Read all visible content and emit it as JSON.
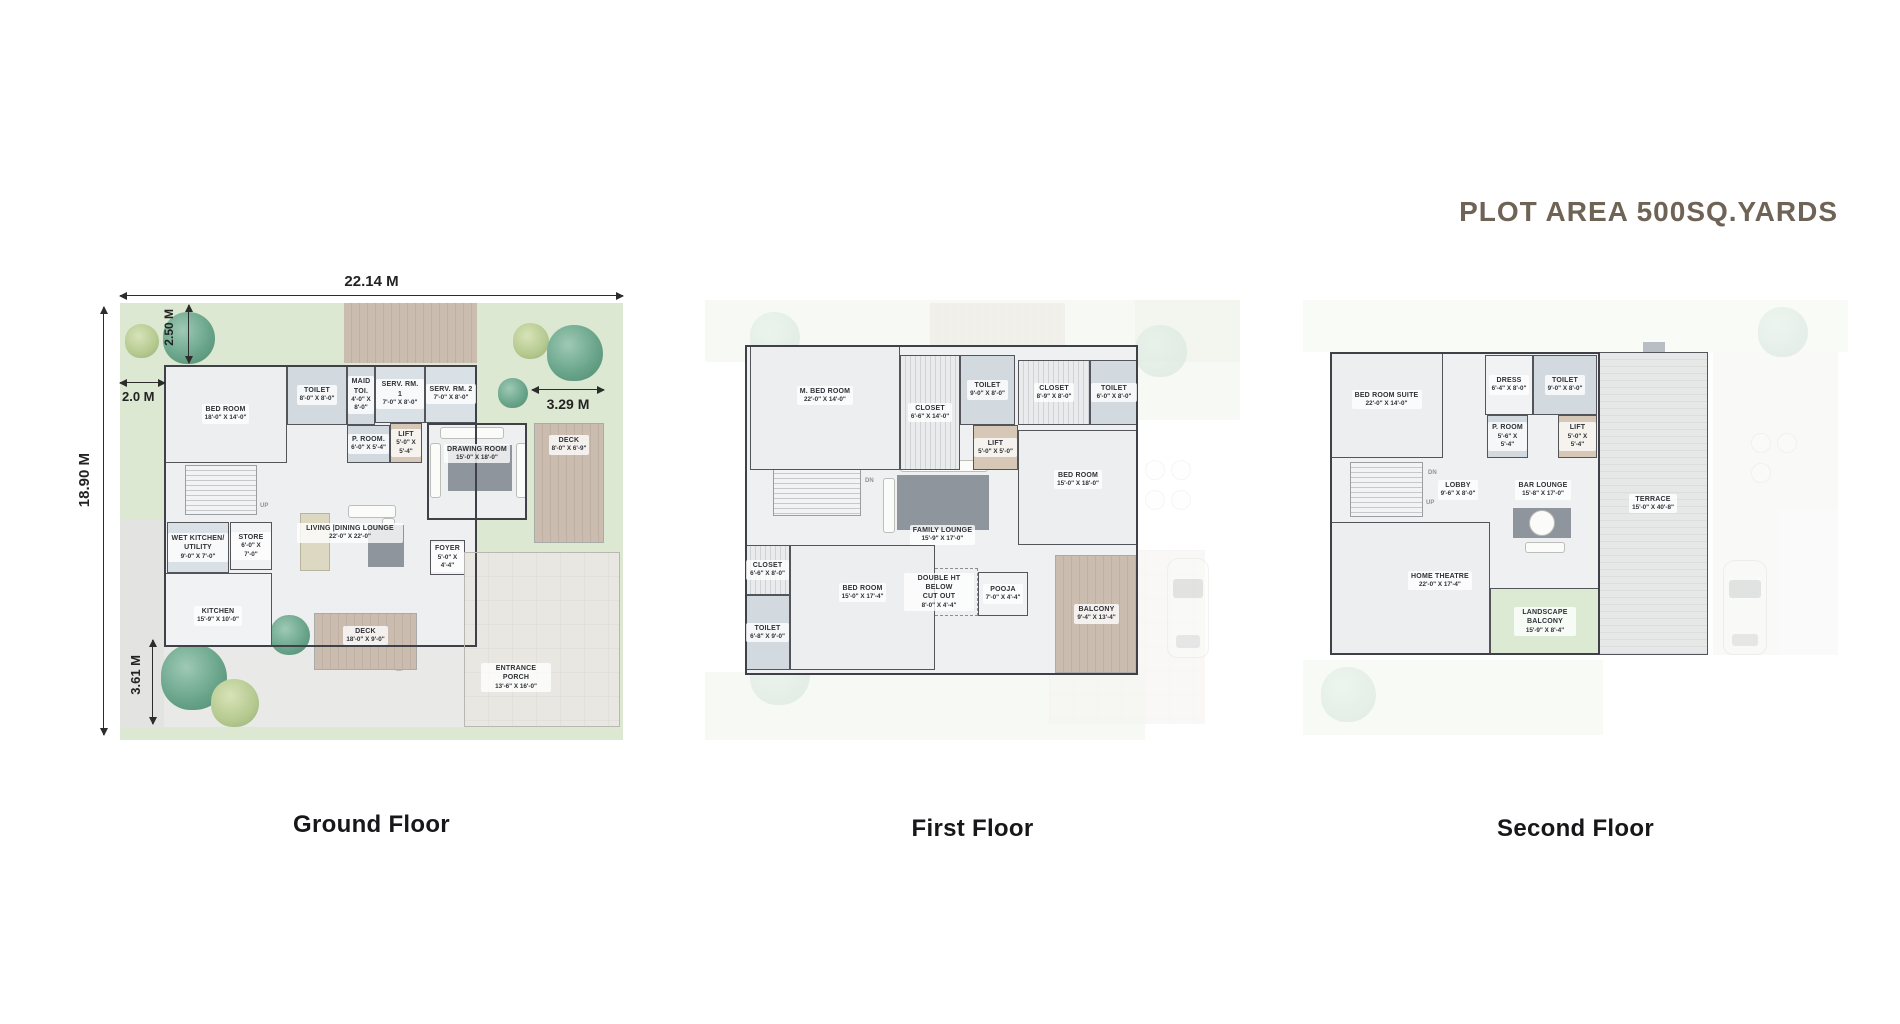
{
  "title": "PLOT AREA 500SQ.YARDS",
  "colors": {
    "title": "#6f6355",
    "wall": "#404148",
    "lawn": "#dce8d1",
    "wood": "#c5b6aa",
    "wet": "#d2dae0",
    "floor": "#eceef0",
    "lift": "#d6c7b6",
    "rug": "#8e959c"
  },
  "floors": [
    {
      "label": "Ground Floor",
      "dims": {
        "top": "22.14 M",
        "left": "18.90 M",
        "top_inner": "2.50 M",
        "left_inner": "2.0 M",
        "right": "3.29 M",
        "bottom": "3.61 M"
      },
      "stairs": {
        "up": "UP"
      },
      "rooms": [
        {
          "name": "BED ROOM",
          "dims": "18'-0\" X 14'-0\""
        },
        {
          "name": "TOILET",
          "dims": "8'-0\" X 8'-0\""
        },
        {
          "name": "MAID TOI.",
          "dims": "4'-0\" X 8'-0\""
        },
        {
          "name": "SERV. RM. 1",
          "dims": "7'-0\" X 8'-0\""
        },
        {
          "name": "SERV. RM. 2",
          "dims": "7'-0\" X 8'-0\""
        },
        {
          "name": "P. ROOM.",
          "dims": "6'-0\" X 5'-4\""
        },
        {
          "name": "LIFT",
          "dims": "5'-0\" X 5'-4\""
        },
        {
          "name": "DRAWING ROOM",
          "dims": "15'-0\" X 18'-0\""
        },
        {
          "name": "DECK",
          "dims": "8'-0\" X 6'-9\""
        },
        {
          "name": "WET KITCHEN/ UTILITY",
          "dims": "9'-0\" X 7'-0\""
        },
        {
          "name": "STORE",
          "dims": "6'-0\" X 7'-0\""
        },
        {
          "name": "KITCHEN",
          "dims": "15'-9\" X 10'-0\""
        },
        {
          "name": "LIVING |DINING LOUNGE",
          "dims": "22'-0\" X 22'-0\""
        },
        {
          "name": "FOYER",
          "dims": "5'-0\" X 4'-4\""
        },
        {
          "name": "DECK",
          "dims": "18'-0\" X 9'-0\""
        },
        {
          "name": "ENTRANCE PORCH",
          "dims": "13'-6\" X 16'-0\""
        }
      ]
    },
    {
      "label": "First Floor",
      "stairs": {
        "dn": "DN"
      },
      "rooms": [
        {
          "name": "M. BED ROOM",
          "dims": "22'-0\" X 14'-0\""
        },
        {
          "name": "CLOSET",
          "dims": "6'-6\" X 14'-0\""
        },
        {
          "name": "TOILET",
          "dims": "9'-0\" X 8'-0\""
        },
        {
          "name": "LIFT",
          "dims": "5'-0\" X 5'-0\""
        },
        {
          "name": "CLOSET",
          "dims": "8'-9\" X 8'-0\""
        },
        {
          "name": "TOILET",
          "dims": "6'-0\" X 8'-0\""
        },
        {
          "name": "BED ROOM",
          "dims": "15'-0\" X 18'-0\""
        },
        {
          "name": "FAMILY LOUNGE",
          "dims": "15'-9\" X 17'-0\""
        },
        {
          "name": "DOUBLE HT BELOW",
          "name2": "CUT OUT",
          "dims": "8'-0\" X 4'-4\""
        },
        {
          "name": "POOJA",
          "dims": "7'-0\" X 4'-4\""
        },
        {
          "name": "BED ROOM",
          "dims": "15'-0\" X 17'-4\""
        },
        {
          "name": "CLOSET",
          "dims": "6'-6\" X 8'-0\""
        },
        {
          "name": "TOILET",
          "dims": "6'-8\" X 9'-0\""
        },
        {
          "name": "BALCONY",
          "dims": "9'-4\" X 13'-4\""
        }
      ]
    },
    {
      "label": "Second Floor",
      "stairs": {
        "dn": "DN",
        "up": "UP"
      },
      "rooms": [
        {
          "name": "BED ROOM SUITE",
          "dims": "22'-0\" X 14'-0\""
        },
        {
          "name": "DRESS",
          "dims": "6'-4\" X 8'-0\""
        },
        {
          "name": "TOILET",
          "dims": "9'-0\" X 8'-0\""
        },
        {
          "name": "P. ROOM",
          "dims": "5'-6\" X 5'-4\""
        },
        {
          "name": "LIFT",
          "dims": "5'-0\" X 5'-4\""
        },
        {
          "name": "LOBBY",
          "dims": "9'-6\" X 8'-0\""
        },
        {
          "name": "BAR LOUNGE",
          "dims": "15'-8\" X 17'-0\""
        },
        {
          "name": "TERRACE",
          "dims": "15'-0\" X 40'-8\""
        },
        {
          "name": "HOME THEATRE",
          "dims": "22'-0\" X 17'-4\""
        },
        {
          "name": "LANDSCAPE BALCONY",
          "dims": "15'-9\" X 8'-4\""
        }
      ]
    }
  ]
}
